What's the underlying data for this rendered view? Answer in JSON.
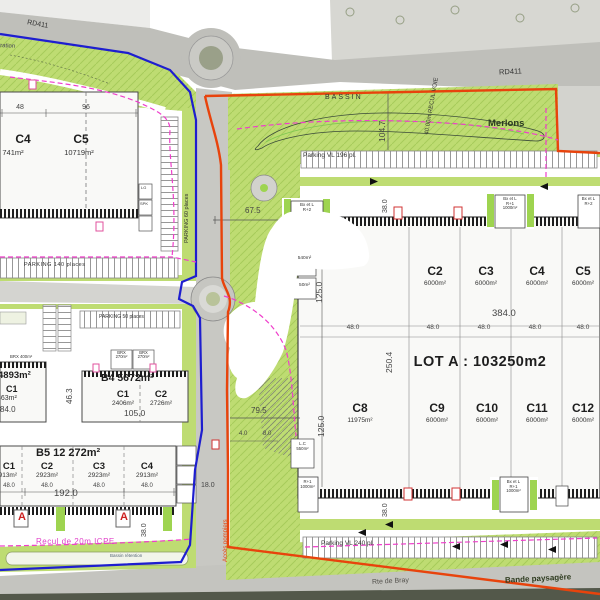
{
  "roads": {
    "rd411_left": "RD411",
    "rd411_right": "RD411",
    "rte_de_bray": "Rte de Bray",
    "bande_paysagere": "Bande paysagère"
  },
  "landscape": {
    "infiltration": "d'infiltration",
    "bassin": "BASSIN",
    "merlons": "Merlons",
    "recul_voie": "40.00m RECUL VOIE",
    "bassin_retention": "Bassin rétention",
    "recul_icpe": "Recul de 20m ICPE",
    "acces_pompiers": "Accès pompiers"
  },
  "parkings": {
    "vl196": "Parking VL 196 pl.",
    "vl240": "Parking VL 240 pl.",
    "p140": "PARKING 140 places",
    "p60": "PARKING 60 places",
    "p50": "PARKING 50 places"
  },
  "tl_building": {
    "c4": "C4",
    "c4_area": "741m²",
    "c5": "C5",
    "c5_area": "10719m²",
    "d48": "48",
    "d96": "96",
    "lg": "LG",
    "spk": "SPK"
  },
  "b3": {
    "area": "4893m²",
    "c1": "C1",
    "c1_area": "463m²",
    "dim": "84.0",
    "brx": "BRX 400m²"
  },
  "b4": {
    "title": "B4 5672m²",
    "c1": "C1",
    "c1_area": "2406m²",
    "c2": "C2",
    "c2_area": "2726m²",
    "width": "105.0",
    "depth": "46.3",
    "brx": "BRX\n270m²"
  },
  "b5": {
    "title": "B5 12 272m²",
    "cells": [
      {
        "name": "C1",
        "area": "2913m²",
        "w": "48.0"
      },
      {
        "name": "C2",
        "area": "2923m²",
        "w": "48.0"
      },
      {
        "name": "C3",
        "area": "2923m²",
        "w": "48.0"
      },
      {
        "name": "C4",
        "area": "2913m²",
        "w": "48.0"
      }
    ],
    "width": "192.0",
    "depth": "38.0",
    "marker": "A"
  },
  "lot_a": {
    "label": "LOT A : 103250m2",
    "top_cells": [
      {
        "name": "C2",
        "area": "6000m²"
      },
      {
        "name": "C3",
        "area": "6000m²"
      },
      {
        "name": "C4",
        "area": "6000m²"
      },
      {
        "name": "C5",
        "area": "6000m²"
      }
    ],
    "bottom_cells": [
      {
        "name": "C8",
        "area": "11975m²"
      },
      {
        "name": "C9",
        "area": "6000m²"
      },
      {
        "name": "C10",
        "area": "6000m²"
      },
      {
        "name": "C11",
        "area": "6000m²"
      },
      {
        "name": "C12",
        "area": "6000m²"
      }
    ],
    "d384": "384.0",
    "d48": "48.0",
    "d250": "250.4",
    "d125": "125.0"
  },
  "annexes": {
    "bx_r2": "Bx et L\nR+2",
    "bx_r1_1000": "Bx et L\nR+1\n1000m²",
    "r1_1000": "R+1\n1000m²",
    "lc": "L.C\n550m²",
    "a540": "540m²",
    "a50": "50m²"
  },
  "dims": {
    "d67": "67.5",
    "d104": "104.7",
    "d38": "38.0",
    "d79": "79.5",
    "d4": "4.0",
    "d8": "8.0",
    "d18": "18.0"
  },
  "colors": {
    "green": "#bedc72",
    "road": "#c4c4bf",
    "red_boundary": "#e8430c",
    "blue_boundary": "#1e1ecf",
    "magenta": "#ef3ecb"
  }
}
